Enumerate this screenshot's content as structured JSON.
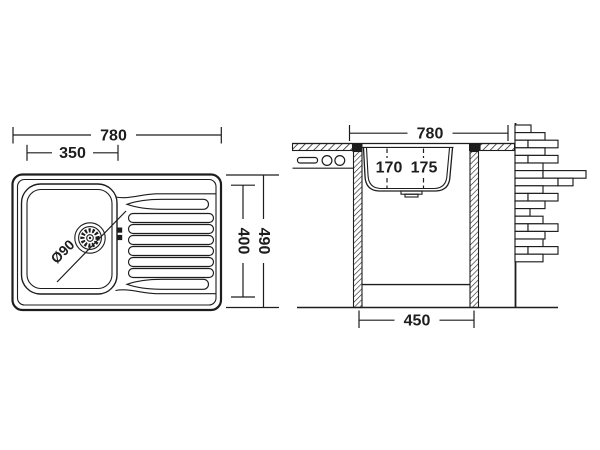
{
  "colors": {
    "background": "#ffffff",
    "line": "#1d1d1d"
  },
  "top_view": {
    "width_label": "780",
    "bowl_width_label": "350",
    "depth_label": "490",
    "bowl_depth_label": "400",
    "drain_diameter_label": "Ø90"
  },
  "section_view": {
    "width_label": "780",
    "bowl_depth_left_label": "170",
    "bowl_depth_right_label": "175",
    "cabinet_width_label": "450"
  }
}
